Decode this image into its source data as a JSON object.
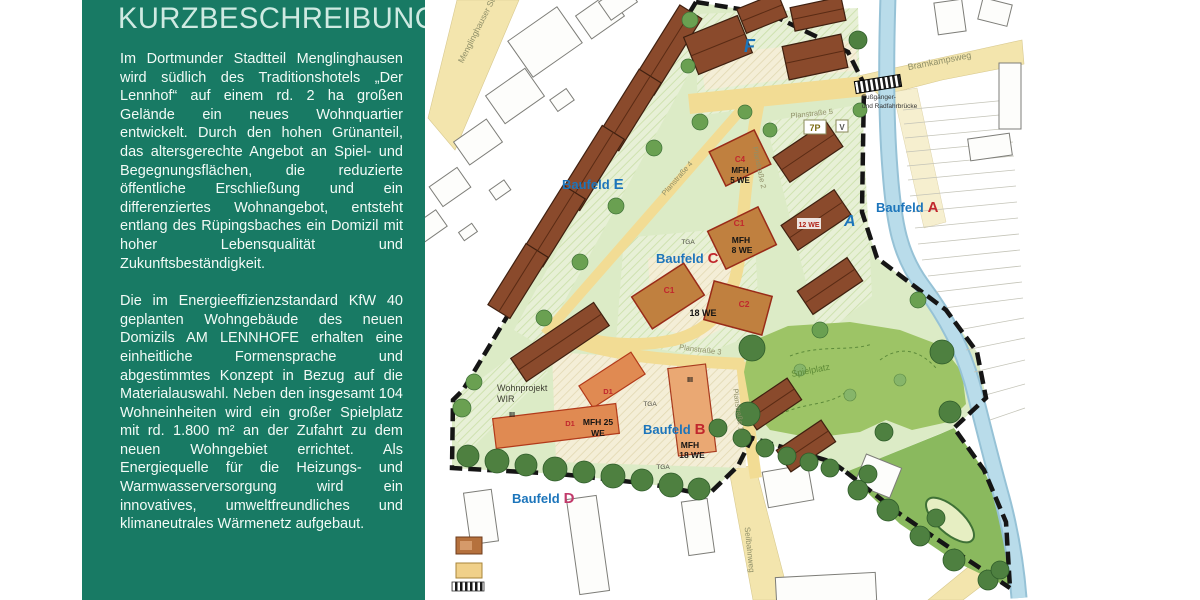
{
  "sidebar": {
    "title": "KURZBESCHREIBUNG",
    "paragraph1": "Im Dortmunder Stadtteil Menglinghausen wird südlich des Traditionshotels „Der Lennhof“ auf einem rd. 2 ha großen Gelände ein neues Wohnquartier entwickelt. Durch den hohen Grünanteil, das altersgerechte Angebot an Spiel- und Begegnungsflächen, die reduzierte öffentliche Erschließung und ein differenziertes Wohnangebot, entsteht entlang des Rüpingsbaches ein Domizil mit hoher Lebensqualität und Zukunftsbeständigkeit.",
    "paragraph2": "Die im Energieeffizienzstandard KfW 40 geplanten Wohngebäude des neuen Domizils AM LENNHOFE erhalten eine einheitliche Formensprache und abgestimmtes Konzept in Bezug auf die Materialauswahl. Neben den insgesamt 104 Wohneinheiten wird ein großer Spielplatz mit rd. 1.800 m² an der Zufahrt zu dem neuen Wohngebiet errichtet. Als Energiequelle für die Heizungs- und Warmwasserversorgung wird ein innovatives, umweltfreundliches und klimaneutrales Wärmenetz aufgebaut.",
    "bg_color": "#187a64",
    "title_color": "#cfeae2",
    "text_color": "#f2faf6"
  },
  "map": {
    "baufeld": {
      "prefix": "Baufeld",
      "a": "A",
      "b": "B",
      "c": "C",
      "d": "D",
      "e": "E",
      "f_marker": "F",
      "a_marker": "A"
    },
    "streets": {
      "menglinghauser": "Menglinghauser Str.",
      "bramkampsweg": "Bramkampsweg",
      "planstrasse1": "Planstraße 1",
      "planstrasse2": "Planstraße 2",
      "planstrasse3": "Planstraße 3",
      "planstrasse4": "Planstraße 4",
      "planstrasse5": "Planstraße 5",
      "seilbahnweg": "Seilbahnweg"
    },
    "buildings": {
      "c4_code": "C4",
      "c4_type": "MFH",
      "c4_units": "5 WE",
      "c1_code": "C1",
      "c1_type": "MFH",
      "c1_units": "8 WE",
      "c1b_code": "C1",
      "c2_code": "C2",
      "c12_units": "18 WE",
      "a_units": "12 WE",
      "d1_code": "D1",
      "mfh25_line1": "MFH 25",
      "mfh25_line2": "WE",
      "b_type": "MFH",
      "b_units": "18 WE",
      "floors": "III"
    },
    "annotations": {
      "wohnprojekt_line1": "Wohnprojekt",
      "wohnprojekt_line2": "WIR",
      "spielplatz": "Spielplatz",
      "tga": "TGA",
      "parking": "7P",
      "visitor": "V",
      "bridge_line1": "Fußgänger-",
      "bridge_line2": "und Radfahrbrücke"
    },
    "colors": {
      "label_blue": "#1c75bb",
      "label_red": "#c1272d",
      "label_pink": "#c23a6b",
      "road_yellow": "#f3e5ad",
      "street_yellow": "#f2dc94",
      "lawn_green": "#dcebc6",
      "play_green": "#9dc466",
      "roof_brown": "#8a4a2c",
      "mfh_orange": "#e08a52",
      "stream_blue": "#aed4e4"
    }
  }
}
